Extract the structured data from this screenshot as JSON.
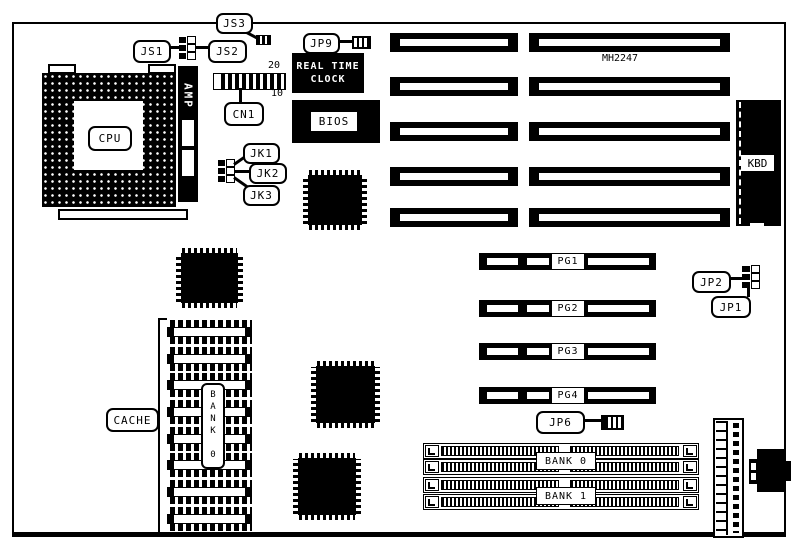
{
  "colors": {
    "ink": "#000000",
    "paper": "#ffffff"
  },
  "labels": {
    "cpu": "CPU",
    "amp": "AMP",
    "cache": "CACHE",
    "cache_bank_vertical": "BANK 0",
    "rtc_line1": "REAL TIME",
    "rtc_line2": "CLOCK",
    "bios": "BIOS",
    "kbd": "KBD",
    "chipset": "MH2247",
    "cn1": "CN1",
    "cn1_pin_top": "20",
    "cn1_pin_bottom": "10",
    "js1": "JS1",
    "js2": "JS2",
    "js3": "JS3",
    "jk1": "JK1",
    "jk2": "JK2",
    "jk3": "JK3",
    "jp1": "JP1",
    "jp2": "JP2",
    "jp6": "JP6",
    "jp9": "JP9"
  },
  "pg_slots": [
    {
      "label": "PG1"
    },
    {
      "label": "PG2"
    },
    {
      "label": "PG3"
    },
    {
      "label": "PG4"
    }
  ],
  "memory_banks": [
    {
      "label": "BANK 0"
    },
    {
      "label": "BANK 1"
    }
  ]
}
